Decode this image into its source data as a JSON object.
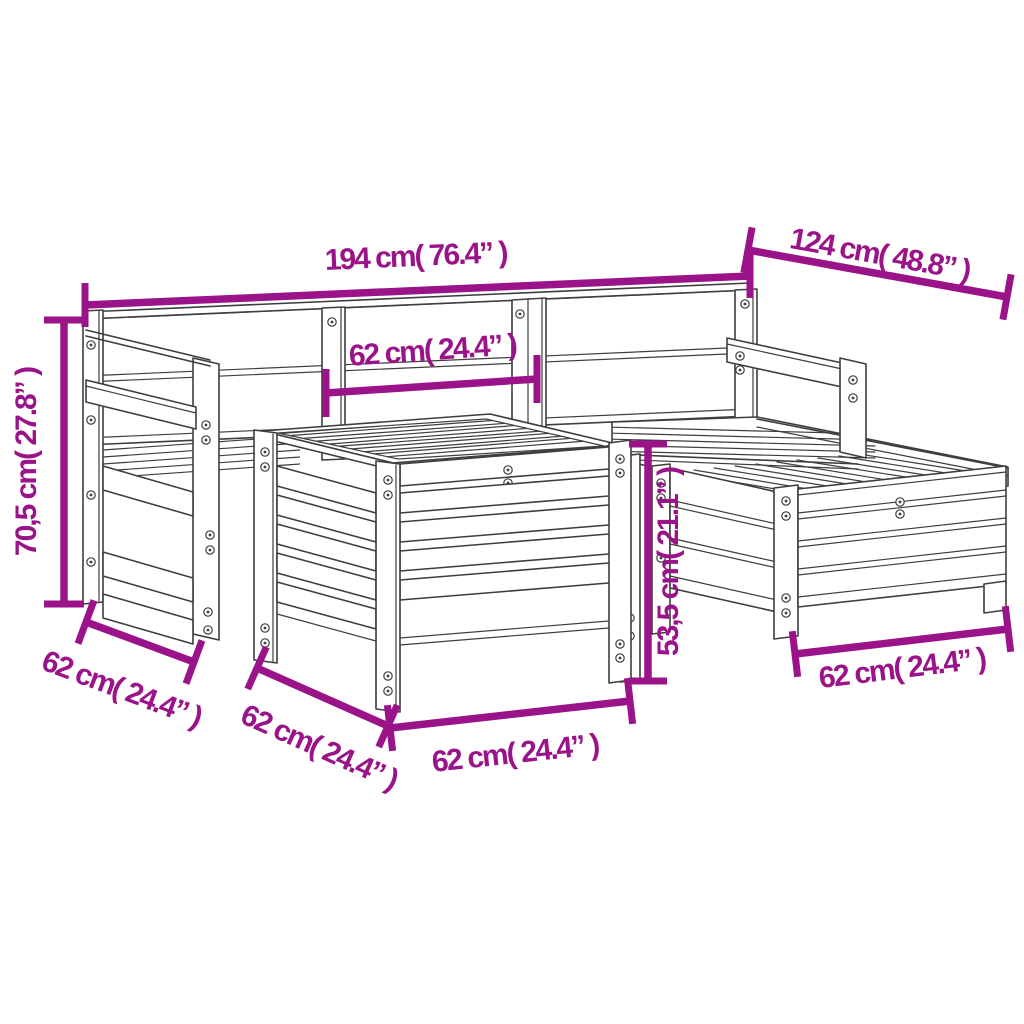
{
  "image": {
    "kind": "product-dimension-diagram",
    "subject": "5 piece wooden garden sofa set line drawing"
  },
  "colors": {
    "dimension": "#9B1389",
    "line": "#3E3E3E",
    "background": "#FFFFFF"
  },
  "dimensions": [
    {
      "id": "overall-width-back",
      "label": "194 cm( 76.4” )"
    },
    {
      "id": "overall-depth-right",
      "label": "124 cm( 48.8” )"
    },
    {
      "id": "backrest-section-width",
      "label": "62 cm( 24.4” )"
    },
    {
      "id": "overall-height-left",
      "label": "70,5 cm( 27.8” )"
    },
    {
      "id": "chair-depth-left",
      "label": "62 cm( 24.4” )"
    },
    {
      "id": "ottoman-depth-left",
      "label": "62 cm( 24.4” )"
    },
    {
      "id": "ottoman-width-front",
      "label": "62 cm( 24.4” )"
    },
    {
      "id": "seat-height-center",
      "label": "53,5 cm( 21.1” )"
    },
    {
      "id": "footstool-width-front",
      "label": "62 cm( 24.4” )"
    }
  ]
}
